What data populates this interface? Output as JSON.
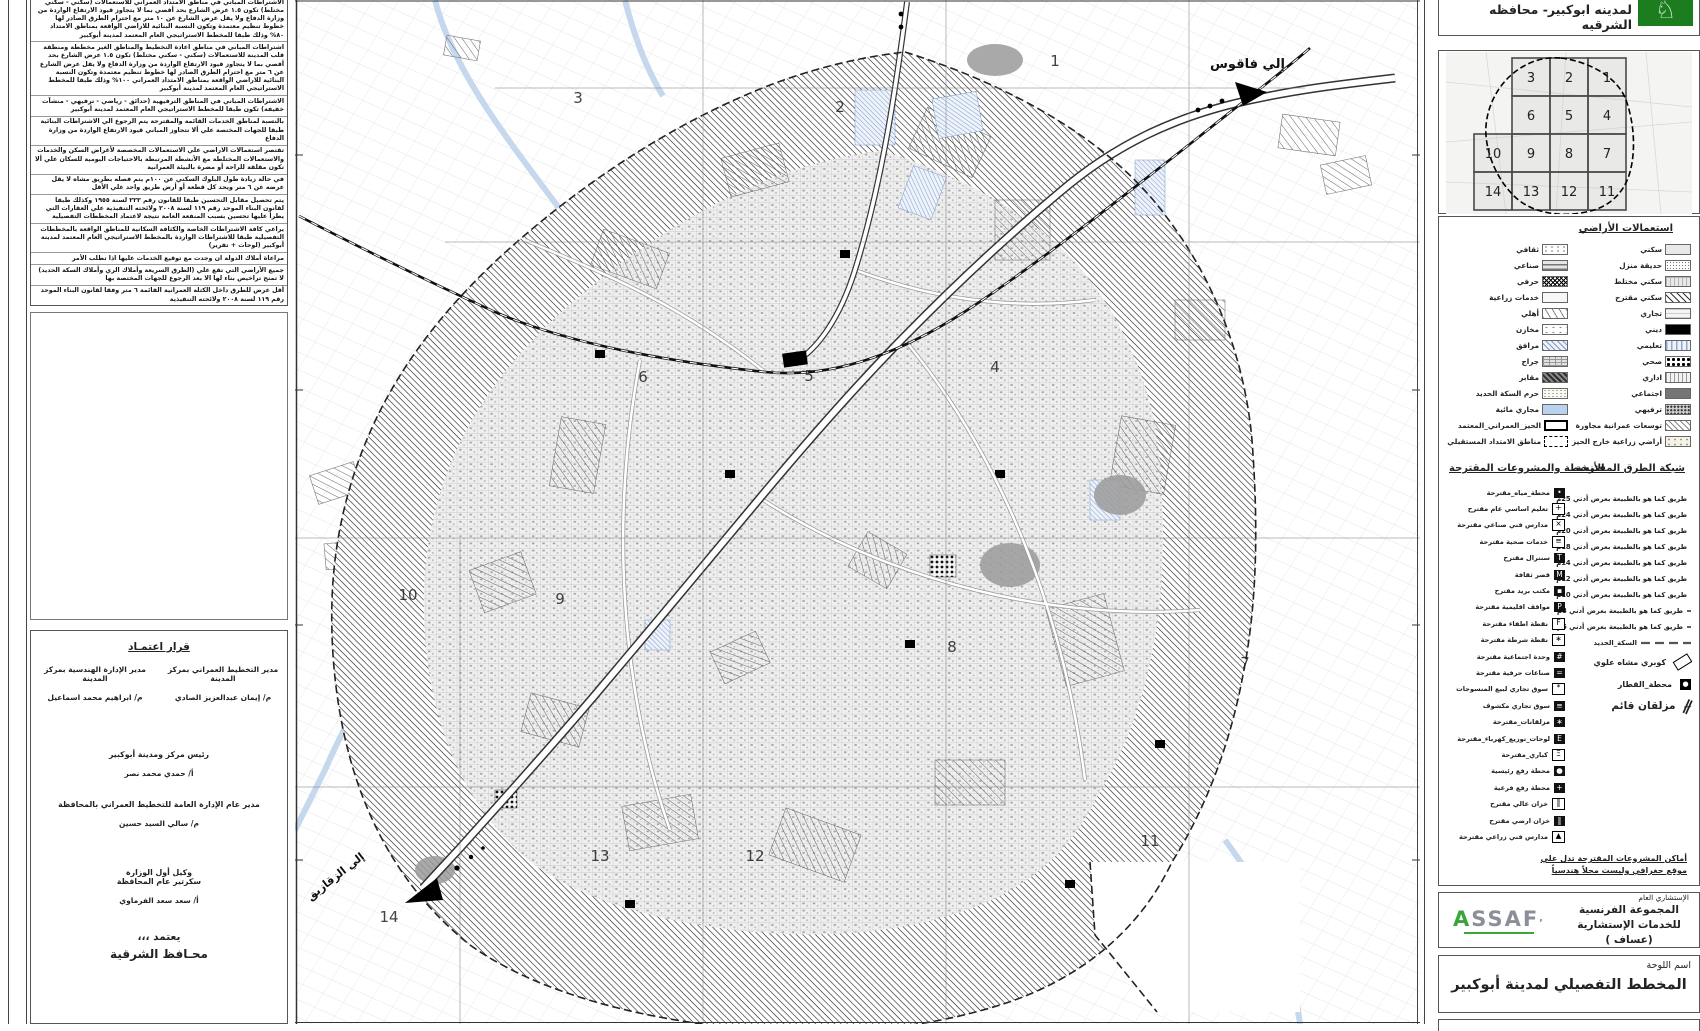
{
  "title_bar": {
    "title": "لمدينه ابوكبير- محافظه الشرقيه",
    "logo": "sharqia-governorate-logo"
  },
  "index_map": {
    "rows": [
      [
        "3",
        "2",
        "1"
      ],
      [
        "6",
        "5",
        "4"
      ],
      [
        "10",
        "9",
        "8",
        "7"
      ],
      [
        "14",
        "13",
        "12",
        "11"
      ]
    ]
  },
  "requirements": {
    "paragraphs": [
      "الاشتراطات المباني في مناطق الامتداد العمراني للاستعمالات (سكني - سكني مختلط) تكون ١.٥ عرض الشارع بحد أقصي بما لا يتجاوز قيود الارتفاع الواردة من وزارة الدفاع ولا يقل عرض الشارع عن ١٠ متر مع احترام الطرق الصادر لها خطوط تنظيم معتمدة وتكون النسبة البنائية للاراضي الواقعة بمناطق الامتداد ٨٠% وذلك طبقا للمخطط الاستراتيجي العام المعتمد لمدينة أبوكبير",
      "اشتراطات المباني في مناطق اعادة التخطيط والمناطق الغير مخططة ومنطقة قلب المدينة للاستعمالات (سكني - سكني مختلط) تكون ١.٥ عرض الشارع بحد أقصي بما لا يتجاوز قيود الارتفاع الواردة من وزارة الدفاع ولا يقل عرض الشارع عن ٦ متر مع احترام الطرق الصادر لها خطوط تنظيم معتمدة وتكون النسبة البنائية للاراضي الواقعة بمناطق الامتداد العمراني ١٠٠% وذلك طبقا للمخطط الاستراتيجي العام المعتمد لمدينة أبوكبير",
      "الاشتراطات المباني في المناطق الترفيهية (حدائق - رياضي - ترفيهي - منشآت خفيفة) تكون طبقا للمخطط الاستراتيجي العام المعتمد لمدينة أبوكبير",
      "بالنسبة لمناطق الخدمات القائمة والمقترحة يتم الرجوع الي الاشتراطات البنائية طبقا للجهات المختصة علي ألا تتجاوز المباني قيود الارتفاع الواردة من وزارة الدفاع",
      "تقتصر استعمالات الاراضي علي الاستعمالات المخصصة لأغراض السكن والخدمات والاستعمالات المختلطة مع الأنشطة المرتبطة بالاحتياجات اليومية للسكان علي ألا تكون مقلقة للراحة أو مضرة بالبيئة العمرانية",
      "في حالة زيادة طول البلوك السكني عن ١٠٠م يتم فصله بطريق مشاه لا يقل عرضه عن ٦ متر ويحد كل قطعة أو أرض طريق واحد علي الأقل",
      "يتم تحصيل مقابل التحسين طبقا للقانون رقم ٢٢٢ لسنة ١٩٥٥ وكذلك طبقا لقانون البناء الموحد رقم ١١٩ لسنة ٢٠٠٨ ولائحته التنفيذية علي العقارات التي يطرأ عليها تحسين بسبب المنفعة العامة نتيجة لاعتماد المخططات التفصيلية",
      "يراعي كافة الاشتراطات الخاصة والكثافة السكانية للمناطق الواقعة بالمخططات التفصيلية طبقا للاشتراطات الواردة بالمخطط الاستراتيجي العام المعتمد لمدينة أبوكبير (لوحات + تقرير)",
      "مراعاة أملاك الدولة ان وجدت مع توقيع الخدمات عليها اذا تطلب الأمر",
      "جميع الأراضي التي تقع علي (الطرق السريعة وأملاك الري وأملاك السكة الحديد) لا تمنح تراخيص بناء لها الا بعد الرجوع للجهات المختصة بها",
      "أقل عرض للطرق داخل الكتلة العمرانية القائمة ٦ متر وفقا لقانون البناء الموحد رقم ١١٩ لسنة ٢٠٠٨ ولائحته التنفيذية",
      "قطعة الأرض التي تقع علي شارعين مختلفي العروض يتم احتساب الارتفاع المبني علي عرض الشارع الأكبر بما لا يتعارض مع قيود الارتفاع الواردة بموافقة وزارة الدفاع",
      "في حالة وجود شوارع غير مدرجة بالمخطط التفصيلي يتم الرجوع فيها الي الإدارة العامة للتخطيط العمراني بالمحافظة لاتخاذ اللازم وفقا للقانون",
      "يتم الالتزام بعروض الطرق الأكبر الموجودة بالطبيعة اذا اختلف العرض عن المخطط التفصيلي",
      "يتم التعامل علي زوائد تنظيم الطرق طبقا لقوانين أملاك الدولة وقانون البناء الموحد رقم ١١٩ لسنة ٢٠٠٨ ولائحته التنفيذية",
      "مراعاة حرم الترع والمصارف والسكك الحديدية وخطوط الضغط العالي والمتوسط وفقا للجهات المختصة بذلك والرجوع الي هذه الجهات في حال التعامل علي هذا الحرم"
    ]
  },
  "approval": {
    "title": "قرار اعتمـاد",
    "col_left_role": "مدير الإدارة الهندسية بمركز المدينة",
    "col_left_name": "م/ ابراهيم محمد اسماعيل",
    "col_right_role": "مدير التخطيط العمراني بمركز المدينة",
    "col_right_name": "م/ إيمان عبدالعزيز الصادي",
    "center1_role": "رئيس مركز ومدينة أبوكبير",
    "center1_name": "أ/ حمدي محمد نصر",
    "center2_role": "مدير عام الإدارة العامة للتخطيط العمراني بالمحافظة",
    "center2_name": "م/ سالي السيد حسين",
    "center3_role1": "وكيل أول الوزارة",
    "center3_role2": "سكرتير عام المحافظة",
    "center3_name": "أ/ سعد سعد الفرماوي",
    "footer1": "يعتمد ،،،",
    "footer2": "محـافظ الشرقية"
  },
  "land_use": {
    "heading": "استعمالات الأراضي",
    "rows": [
      {
        "right": {
          "label": "سكني",
          "swatch": "plainlt"
        },
        "left": {
          "label": "ثقافي",
          "swatch": "vpat"
        }
      },
      {
        "right": {
          "label": "حديقة منزل",
          "swatch": "dotgrid"
        },
        "left": {
          "label": "صناعي",
          "swatch": "brick"
        }
      },
      {
        "right": {
          "label": "سكني مختلط",
          "swatch": "grid"
        },
        "left": {
          "label": "حرفي",
          "swatch": "cross"
        }
      },
      {
        "right": {
          "label": "سكني مقترح",
          "swatch": "hatch"
        },
        "left": {
          "label": "خدمات زراعية",
          "swatch": "plainx"
        }
      },
      {
        "right": {
          "label": "تجاري",
          "swatch": "hlines"
        },
        "left": {
          "label": "أهلي",
          "swatch": "ticks"
        }
      },
      {
        "right": {
          "label": "ديني",
          "swatch": "black"
        },
        "left": {
          "label": "مخازن",
          "swatch": "dotsparse"
        }
      },
      {
        "right": {
          "label": "تعليمي",
          "swatch": "vblue"
        },
        "left": {
          "label": "مرافق",
          "swatch": "bluehatch"
        }
      },
      {
        "right": {
          "label": "صحي",
          "swatch": "dotsbold"
        },
        "left": {
          "label": "جراج",
          "swatch": "weave"
        }
      },
      {
        "right": {
          "label": "اداري",
          "swatch": "vlines"
        },
        "left": {
          "label": "مقابر",
          "swatch": "cemetery"
        }
      },
      {
        "right": {
          "label": "اجتماعي",
          "swatch": "gray"
        },
        "left": {
          "label": "حرم السكة الحديد",
          "swatch": "stipple"
        }
      },
      {
        "right": {
          "label": "ترفيهي",
          "swatch": "speckle"
        },
        "left": {
          "label": "مجاري مائية",
          "swatch": "water"
        }
      },
      {
        "right": {
          "label": "توسعات عمرانية مجاورة",
          "swatch": "hatchlt"
        },
        "left": {
          "label": "الحيز_العمراني_المعتمد",
          "swatch": "bracket"
        }
      },
      {
        "right": {
          "label": "أراضي زراعية خارج الحيز",
          "swatch": "dotscream"
        },
        "left": {
          "label": "مناطق الامتداد المستقبلي",
          "swatch": "dashedbx"
        }
      }
    ]
  },
  "roads": {
    "heading": "شبكة الطرق المقترحة",
    "items": [
      {
        "label": "طريق كما هو بالطبيعة بعرض أدني 25م",
        "dash": "none",
        "w": 3
      },
      {
        "label": "طريق كما هو بالطبيعة بعرض أدني 24م",
        "dash": "14 4 4 4",
        "w": 2
      },
      {
        "label": "طريق كما هو بالطبيعة بعرض أدني 20م",
        "dash": "10 4 3 4",
        "w": 2
      },
      {
        "label": "طريق كما هو بالطبيعة بعرض أدني 18م",
        "dash": "12 5",
        "w": 1.8
      },
      {
        "label": "طريق كما هو بالطبيعة بعرض أدني 14م",
        "dash": "16 4 2 4",
        "w": 1.6
      },
      {
        "label": "طريق كما هو بالطبيعة بعرض أدني 12م",
        "dash": "10 3 2 3 2 3",
        "w": 1.6
      },
      {
        "label": "طريق كما هو بالطبيعة بعرض أدني 10م",
        "dash": "6 4",
        "w": 1.4
      },
      {
        "label": "طريق كما هو بالطبيعة بعرض أدني 8م",
        "dash": "8 3 2 3",
        "w": 1.2
      },
      {
        "label": "طريق كما هو بالطبيعة بعرض أدني 6م",
        "dash": "4 3 1 3",
        "w": 1.2
      },
      {
        "label": "السكة_الحديد",
        "dash": "9 5",
        "w": 2.2
      }
    ],
    "special": [
      {
        "label": "كوبري مشاه علوي",
        "icon": "bridge-icon"
      },
      {
        "label": "محطة_القطار",
        "icon": "train-station-icon",
        "glyph": "●"
      },
      {
        "label": "مزلقان قائم",
        "icon": "level-crossing-icon",
        "glyph": "∦",
        "big": true
      }
    ]
  },
  "activities": {
    "heading": "الأنشطة والمشروعات المقترحة",
    "items": [
      {
        "label": "محطة_مياه_مقترحة",
        "glyph": "•"
      },
      {
        "label": "تعليم اساسي عام مقترح",
        "glyph": "+",
        "light": true
      },
      {
        "label": "مدارس فني صناعي مقترحة",
        "glyph": "×",
        "light": true
      },
      {
        "label": "خدمات صحية مقترحة",
        "glyph": "≡",
        "light": true
      },
      {
        "label": "سنترال مقترح",
        "glyph": "T"
      },
      {
        "label": "قصر ثقافة",
        "glyph": "M"
      },
      {
        "label": "مكتب بريد مقترح",
        "glyph": "▪"
      },
      {
        "label": "مواقف اقليمية مقترحة",
        "glyph": "P"
      },
      {
        "label": "نقطة اطفاء مقترحة",
        "glyph": "F",
        "light": true
      },
      {
        "label": "نقطة شرطة مقترحة",
        "glyph": "∗",
        "light": true
      },
      {
        "label": "وحدة اجتماعية مقترحة",
        "glyph": "#"
      },
      {
        "label": "صناعات حرفية مقترحة",
        "glyph": "="
      },
      {
        "label": "سوق تجاري لبيع المنسوجات",
        "glyph": "*",
        "light": true
      },
      {
        "label": "سوق تجاري مكشوف",
        "glyph": "≡"
      },
      {
        "label": "مزلقانات_مقترحة",
        "glyph": "∗"
      },
      {
        "label": "لوحات_توزيع_كهرباء_مقترحة",
        "glyph": "E"
      },
      {
        "label": "كباري_مقترحة",
        "glyph": "Ξ",
        "light": true
      },
      {
        "label": "محطة رفع رئيسية",
        "glyph": "●"
      },
      {
        "label": "محطة رفع فرعية",
        "glyph": "+"
      },
      {
        "label": "خزان عالي مقترح",
        "glyph": "‖",
        "light": true
      },
      {
        "label": "خزان ارضي مقترح",
        "glyph": "‖"
      },
      {
        "label": "مدارس فني زراعي مقترحة",
        "glyph": "▲",
        "light": true
      }
    ]
  },
  "footnote": {
    "line1": "أماكن المشروعات المقترحة تدل علي",
    "line2": "موقع جغرافي وليست محلاً هندسياً"
  },
  "consultant": {
    "role": "الإستشاري العام",
    "name1": "المجموعة الفرنسية",
    "name2": "للخدمات الإستشارية (عساف )",
    "logo_a": "A",
    "logo_rest": "SSAF"
  },
  "plate": {
    "label": "اسم اللوحة",
    "name": "المخطط التفصيلي لمدينة أبوكبير"
  },
  "map": {
    "to_faqous": "إلي فاقوس",
    "to_zagazig": "إلي الزقازيق",
    "zones": [
      {
        "n": "1",
        "x": 760,
        "y": 66
      },
      {
        "n": "2",
        "x": 545,
        "y": 112
      },
      {
        "n": "3",
        "x": 283,
        "y": 103
      },
      {
        "n": "4",
        "x": 700,
        "y": 372
      },
      {
        "n": "5",
        "x": 514,
        "y": 381
      },
      {
        "n": "6",
        "x": 348,
        "y": 382
      },
      {
        "n": "7",
        "x": 950,
        "y": 668
      },
      {
        "n": "8",
        "x": 657,
        "y": 652
      },
      {
        "n": "9",
        "x": 265,
        "y": 604
      },
      {
        "n": "10",
        "x": 113,
        "y": 600
      },
      {
        "n": "11",
        "x": 855,
        "y": 846
      },
      {
        "n": "12",
        "x": 460,
        "y": 861
      },
      {
        "n": "13",
        "x": 305,
        "y": 861
      },
      {
        "n": "14",
        "x": 94,
        "y": 922
      }
    ],
    "colors": {
      "water": "#c3d6ec",
      "hatch": "#1a1a1a",
      "accent_green": "#1c7d1f"
    }
  }
}
